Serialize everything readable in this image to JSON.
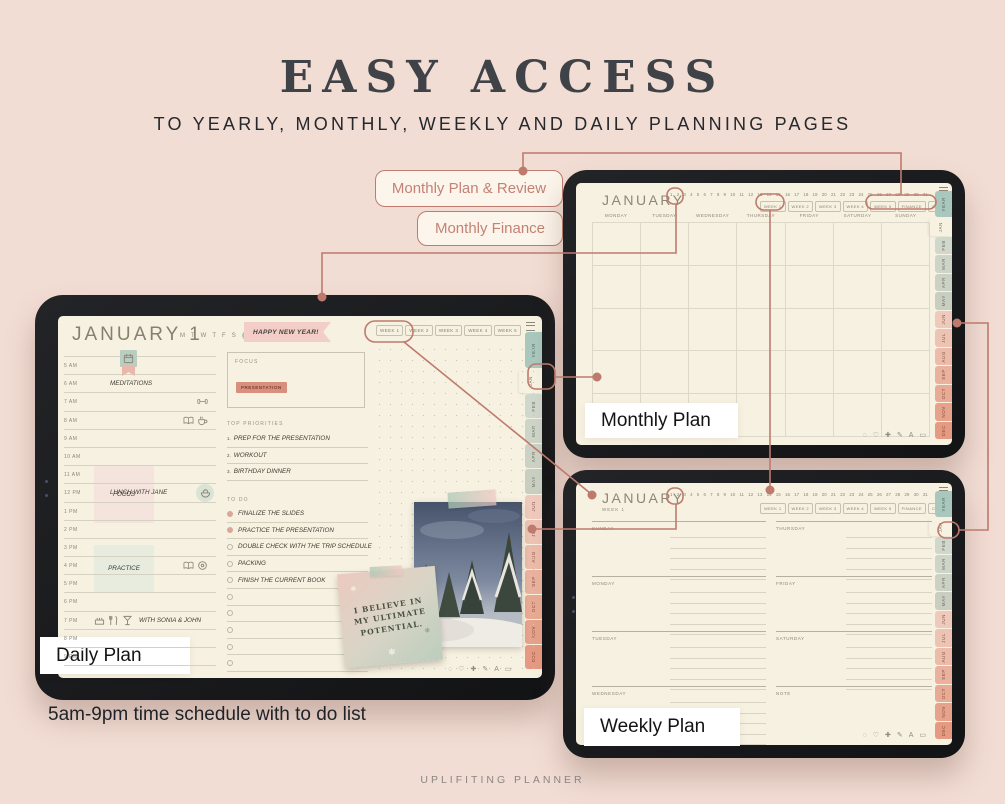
{
  "page": {
    "background": "#f2ddd4",
    "accent_color": "#bd7a6d",
    "screen_color": "#f7f1e1",
    "title": "EASY ACCESS",
    "subtitle": "TO YEARLY, MONTHLY, WEEKLY AND DAILY PLANNING PAGES",
    "caption": "5am-9pm time schedule with to do list",
    "footer": "UPLIFITING PLANNER"
  },
  "callouts": {
    "plan_review": "Monthly Plan & Review",
    "finance": "Monthly Finance"
  },
  "device_labels": {
    "daily": "Daily Plan",
    "monthly": "Monthly Plan",
    "weekly": "Weekly Plan"
  },
  "planner": {
    "dates": [
      "1",
      "2",
      "3",
      "4",
      "5",
      "6",
      "7",
      "8",
      "9",
      "10",
      "11",
      "12",
      "13",
      "14",
      "15",
      "16",
      "17",
      "18",
      "19",
      "20",
      "21",
      "22",
      "23",
      "24",
      "25",
      "26",
      "27",
      "28",
      "29",
      "30",
      "31"
    ],
    "week_buttons": [
      "WEEK 1",
      "WEEK 2",
      "WEEK 3",
      "WEEK 4",
      "WEEK 5"
    ],
    "extra_buttons": [
      "FINANCE",
      "CHECK-IN"
    ],
    "tabs": [
      {
        "label": "YEAR",
        "color": "#a9c7bc",
        "year": true
      },
      {
        "label": "JAN",
        "color": "#f7f1e1",
        "active": true
      },
      {
        "label": "FEB",
        "color": "#d0d7cc"
      },
      {
        "label": "MAR",
        "color": "#cdd4c8"
      },
      {
        "label": "APR",
        "color": "#cbd1c4"
      },
      {
        "label": "MAY",
        "color": "#c8cec0"
      },
      {
        "label": "JUN",
        "color": "#efcabc"
      },
      {
        "label": "JUL",
        "color": "#edc3b3"
      },
      {
        "label": "AUG",
        "color": "#ecbba9"
      },
      {
        "label": "SEP",
        "color": "#eab29e"
      },
      {
        "label": "OCT",
        "color": "#e9aa94"
      },
      {
        "label": "NOV",
        "color": "#e7a28b"
      },
      {
        "label": "DEC",
        "color": "#e59a81"
      }
    ],
    "toolbar_icons": [
      {
        "name": "lasso-icon",
        "glyph": "◌"
      },
      {
        "name": "heart-icon",
        "glyph": "♡"
      },
      {
        "name": "move-icon",
        "glyph": "✚"
      },
      {
        "name": "pen-icon",
        "glyph": "✎"
      },
      {
        "name": "text-icon",
        "glyph": "A"
      },
      {
        "name": "photo-icon",
        "glyph": "▭"
      }
    ]
  },
  "monthly": {
    "title": "JANUARY",
    "day_headers": [
      "MONDAY",
      "TUESDAY",
      "WEDNESDAY",
      "THURSDAY",
      "FRIDAY",
      "SATURDAY",
      "SUNDAY"
    ]
  },
  "weekly": {
    "title": "JANUARY",
    "week_label": "WEEK 1",
    "left_days": [
      "SUNDAY",
      "MONDAY",
      "TUESDAY",
      "WEDNESDAY"
    ],
    "right_days": [
      "THURSDAY",
      "FRIDAY",
      "SATURDAY",
      "NOTE"
    ]
  },
  "daily": {
    "title": "JANUARY 1",
    "weekday_letters": [
      "M",
      "T",
      "W",
      "T",
      "F",
      "S",
      "S"
    ],
    "banner": "HAPPY NEW YEAR!",
    "focus": {
      "label": "FOCUS",
      "tag": "PRESENTATION"
    },
    "priorities": {
      "label": "TOP PRIORITIES",
      "items": [
        "PREP FOR THE PRESENTATION",
        "WORKOUT",
        "BIRTHDAY DINNER"
      ]
    },
    "todo": {
      "label": "TO DO",
      "items": [
        {
          "text": "FINALIZE THE SLIDES",
          "done": true
        },
        {
          "text": "PRACTICE THE PRESENTATION",
          "done": true
        },
        {
          "text": "DOUBLE CHECK WITH THE TRIP SCHEDULE",
          "done": false
        },
        {
          "text": "PACKING",
          "done": false
        },
        {
          "text": "FINISH THE CURRENT BOOK",
          "done": false
        },
        {
          "text": "",
          "done": false
        },
        {
          "text": "",
          "done": false
        },
        {
          "text": "",
          "done": false
        },
        {
          "text": "",
          "done": false
        },
        {
          "text": "",
          "done": false
        }
      ]
    },
    "schedule": [
      {
        "time": "5 AM",
        "bookmark": true
      },
      {
        "time": "6 AM",
        "note": "MEDITATIONS"
      },
      {
        "time": "7 AM",
        "right_icons": [
          "dumbbell-icon"
        ]
      },
      {
        "time": "8 AM",
        "right_icons": [
          "book-icon",
          "coffee-icon"
        ]
      },
      {
        "time": "9 AM"
      },
      {
        "time": "10 AM"
      },
      {
        "time": "11 AM"
      },
      {
        "time": "12 PM",
        "note": "LUNCH WITH JANE",
        "right_icons": [
          "salad-icon"
        ],
        "right_circle": true
      },
      {
        "time": "1 PM"
      },
      {
        "time": "2 PM"
      },
      {
        "time": "3 PM"
      },
      {
        "time": "4 PM",
        "right_icons": [
          "book-icon",
          "donut-icon"
        ]
      },
      {
        "time": "5 PM"
      },
      {
        "time": "6 PM"
      },
      {
        "time": "7 PM",
        "left_icons": [
          "cake-icon",
          "cutlery-icon",
          "drink-icon"
        ],
        "note": "WITH SONIA & JOHN"
      },
      {
        "time": "8 PM"
      },
      {
        "time": "9 PM"
      }
    ],
    "blocks": [
      {
        "label": "FOCUS",
        "class": "focus"
      },
      {
        "label": "PRACTICE",
        "class": "practice"
      }
    ],
    "note_quote": "I BELIEVE IN MY ULTIMATE POTENTIAL."
  }
}
